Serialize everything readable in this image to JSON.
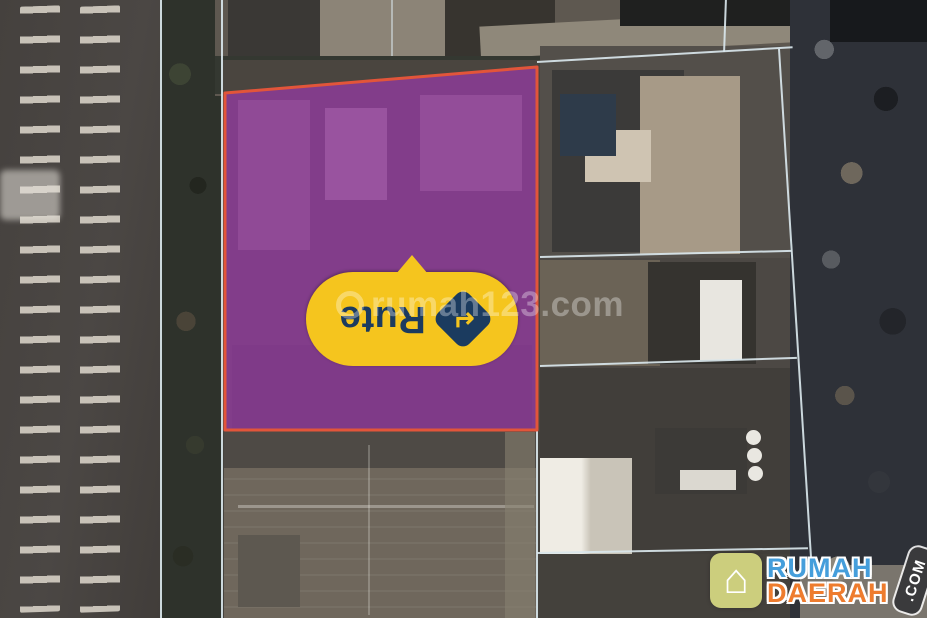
{
  "map": {
    "view": "satellite",
    "boundary_line_color": "#D9E6EB",
    "property_polygon": {
      "points": "225,93 537,67 537,430 225,430",
      "fill": "#983AA8",
      "fill_opacity": 0.72,
      "stroke": "#E2553A"
    },
    "route_marker": {
      "label": "Rute",
      "icon": "directions-arrow-icon",
      "icon_glyph": "↵",
      "bubble_color": "#F5C51E",
      "text_color": "#1B3B5F",
      "rotation_note": "rendered upside down"
    },
    "watermark": {
      "icon": "rumah123-ring-icon",
      "text": "rumah123.com",
      "color": "rgba(255,255,255,0.33)"
    }
  },
  "branding": {
    "icon": "house-icon",
    "house_glyph": "⌂",
    "name_line1": "RUMAH",
    "name_line2": "DAERAH",
    "tld": ".COM",
    "colors": {
      "line1": "#459EDB",
      "line2": "#EE7C2E",
      "tld_bg": "#3A3A3C",
      "icon_bg": "#D8DA83"
    }
  }
}
